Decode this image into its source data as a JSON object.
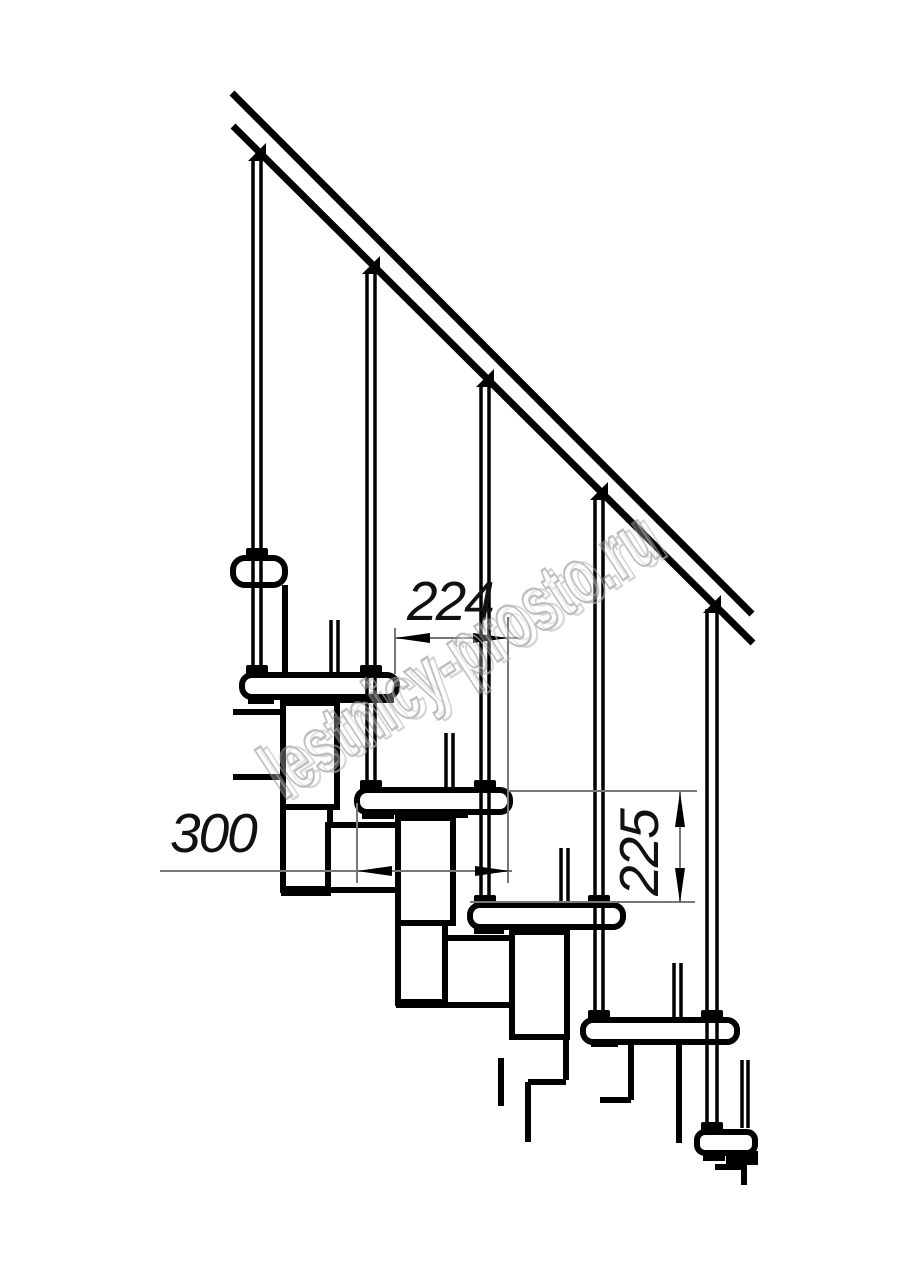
{
  "page": {
    "background": "#ffffff"
  },
  "drawing": {
    "stroke_color": "#000000",
    "thin_line_color": "#787878",
    "dimensions": {
      "dim_224": {
        "label": "224"
      },
      "dim_300": {
        "label": "300"
      },
      "dim_225": {
        "label": "225"
      }
    },
    "watermark": {
      "text": "lestnicy-prosto.ru",
      "color": "#9b9b9b"
    }
  }
}
